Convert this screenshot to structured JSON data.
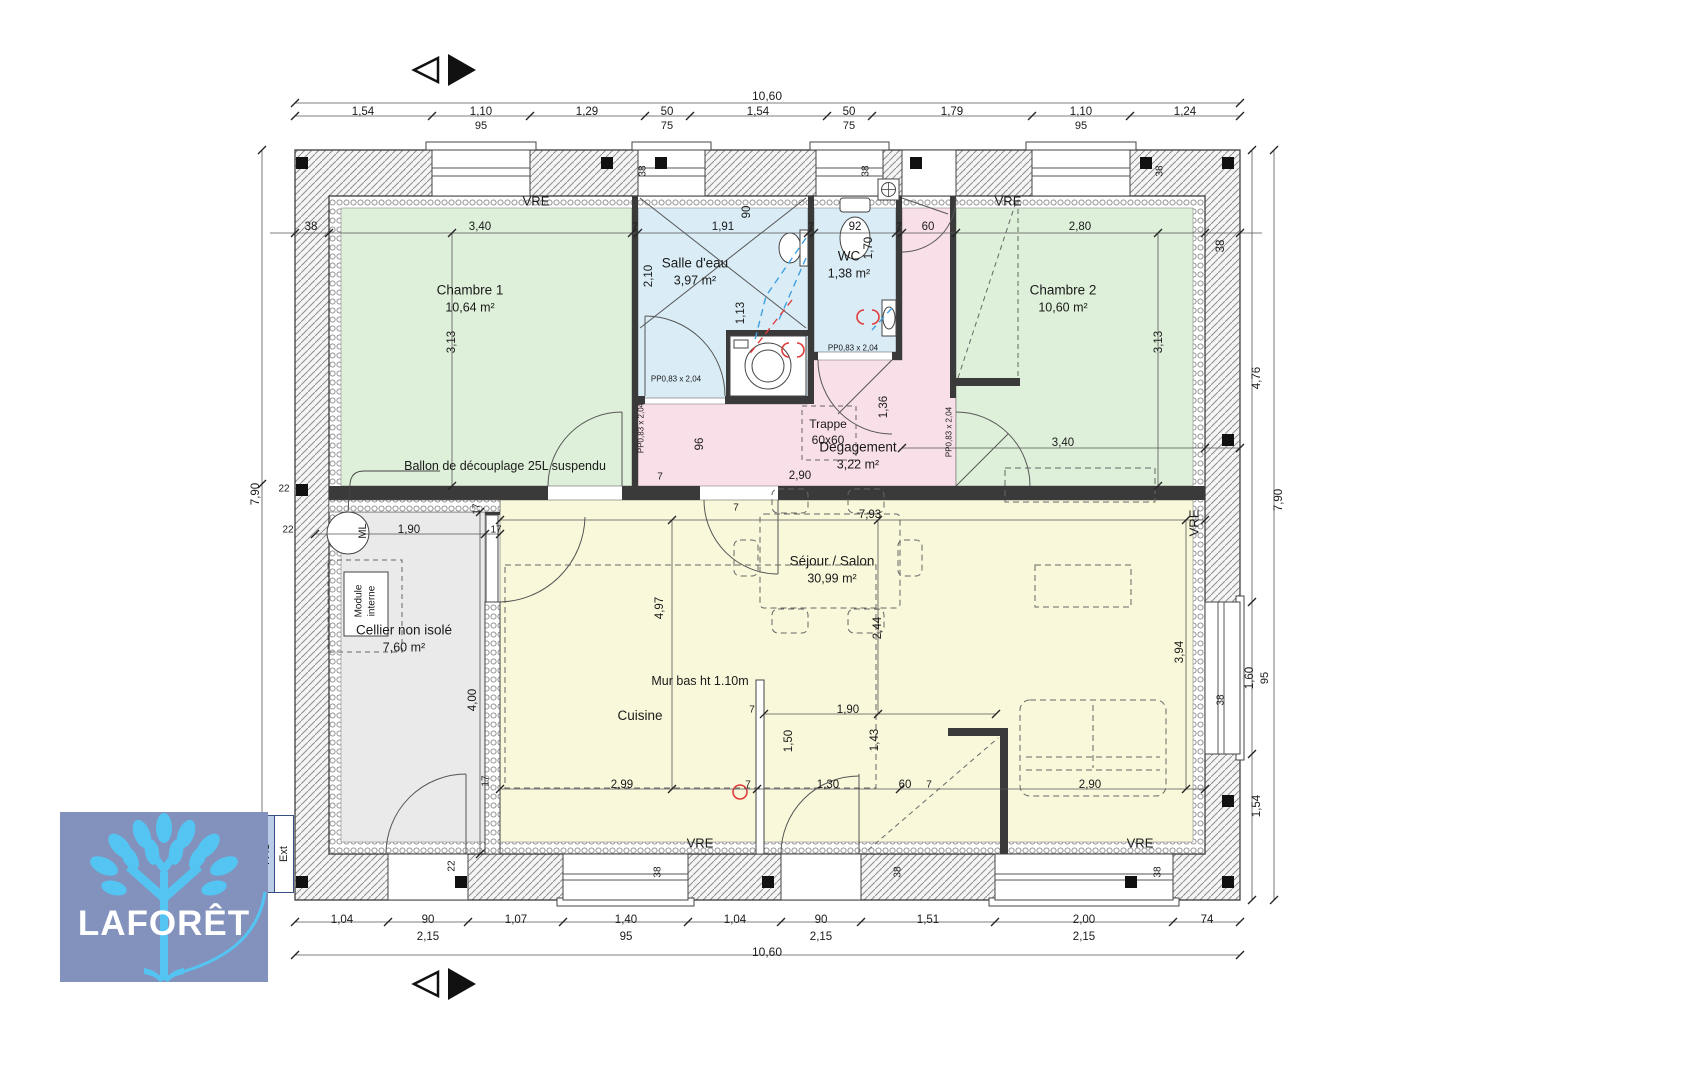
{
  "branding": {
    "logo_text": "LAFORÊT",
    "pac_label": "PAC",
    "ext_label": "Ext"
  },
  "colors": {
    "bedroom": "#dff0da",
    "water": "#daedf7",
    "hall": "#f9dfe8",
    "living": "#f9f8da",
    "cellar": "#eaeaea",
    "wall": "#3a3a3a",
    "dim": "#1a1a1a",
    "logo_bg": "#8292bd",
    "logo_tree": "#54c5f2",
    "logo_text": "#ffffff",
    "pipe_cold": "#3f9fe0",
    "pipe_hot": "#e03b3b",
    "accent_red": "#e03b3b"
  },
  "rooms": [
    {
      "name": "Chambre 1",
      "area": "10,64 m²"
    },
    {
      "name": "Salle d'eau",
      "area": "3,97 m²"
    },
    {
      "name": "WC",
      "area": "1,38 m²"
    },
    {
      "name": "Chambre 2",
      "area": "10,60 m²"
    },
    {
      "name": "Degagement",
      "area": "3,22 m²"
    },
    {
      "name": "Cellier non isolé",
      "area": "7,60 m²"
    },
    {
      "name": "Séjour / Salon",
      "area": "30,99 m²"
    },
    {
      "name": "Cuisine",
      "area": ""
    }
  ],
  "labels": [
    {
      "t": "10,60",
      "x": 767,
      "y": 96,
      "s": 12,
      "n": "dim-total-top"
    },
    {
      "t": "1,54",
      "x": 363,
      "y": 112
    },
    {
      "t": "1,10",
      "x": 481,
      "y": 112
    },
    {
      "t": "95",
      "x": 481,
      "y": 126,
      "s": 11
    },
    {
      "t": "1,29",
      "x": 587,
      "y": 112
    },
    {
      "t": "50",
      "x": 667,
      "y": 112
    },
    {
      "t": "75",
      "x": 667,
      "y": 126,
      "s": 11
    },
    {
      "t": "1,54",
      "x": 758,
      "y": 112
    },
    {
      "t": "50",
      "x": 849,
      "y": 112
    },
    {
      "t": "75",
      "x": 849,
      "y": 126,
      "s": 11
    },
    {
      "t": "1,79",
      "x": 952,
      "y": 112
    },
    {
      "t": "1,10",
      "x": 1081,
      "y": 112
    },
    {
      "t": "95",
      "x": 1081,
      "y": 126,
      "s": 11
    },
    {
      "t": "1,24",
      "x": 1185,
      "y": 112
    },
    {
      "t": "38",
      "x": 311,
      "y": 227
    },
    {
      "t": "3,40",
      "x": 480,
      "y": 227
    },
    {
      "t": "7",
      "x": 635,
      "y": 227,
      "s": 10
    },
    {
      "t": "1,91",
      "x": 723,
      "y": 227
    },
    {
      "t": "90",
      "x": 747,
      "y": 212,
      "r": 1
    },
    {
      "t": "7",
      "x": 811,
      "y": 227,
      "s": 10
    },
    {
      "t": "92",
      "x": 855,
      "y": 227
    },
    {
      "t": "7",
      "x": 899,
      "y": 227,
      "s": 10
    },
    {
      "t": "60",
      "x": 928,
      "y": 227
    },
    {
      "t": "2,80",
      "x": 1080,
      "y": 227
    },
    {
      "t": "38",
      "x": 1221,
      "y": 246,
      "r": 1
    },
    {
      "t": "38",
      "x": 643,
      "y": 171,
      "r": 1,
      "s": 10
    },
    {
      "t": "38",
      "x": 866,
      "y": 171,
      "r": 1,
      "s": 10
    },
    {
      "t": "38",
      "x": 1160,
      "y": 171,
      "r": 1,
      "s": 10
    },
    {
      "t": "3,13",
      "x": 452,
      "y": 342,
      "r": 1
    },
    {
      "t": "2,10",
      "x": 649,
      "y": 276,
      "r": 1
    },
    {
      "t": "1,13",
      "x": 741,
      "y": 313,
      "r": 1
    },
    {
      "t": "1,70",
      "x": 869,
      "y": 248,
      "r": 1
    },
    {
      "t": "3,13",
      "x": 1159,
      "y": 342,
      "r": 1
    },
    {
      "t": "96",
      "x": 700,
      "y": 444,
      "r": 1
    },
    {
      "t": "1,36",
      "x": 884,
      "y": 407,
      "r": 1
    },
    {
      "t": "2,90",
      "x": 800,
      "y": 476
    },
    {
      "t": "Trappe",
      "x": 828,
      "y": 424,
      "s": 12,
      "n": "trappe-label"
    },
    {
      "t": "60x60",
      "x": 828,
      "y": 440,
      "s": 12,
      "n": "trappe-size-label"
    },
    {
      "t": "PP0,83 x 2,04",
      "x": 676,
      "y": 379,
      "s": 8,
      "n": "door-size-label"
    },
    {
      "t": "PP0,83 x 2,04",
      "x": 641,
      "y": 428,
      "r": 1,
      "s": 8,
      "n": "door-size-label"
    },
    {
      "t": "PP0,83 x 2,04",
      "x": 853,
      "y": 348,
      "s": 8,
      "n": "door-size-label"
    },
    {
      "t": "PP0,83 x 2,04",
      "x": 949,
      "y": 432,
      "r": 1,
      "s": 8,
      "n": "door-size-label"
    },
    {
      "t": "3,40",
      "x": 1063,
      "y": 443
    },
    {
      "t": "VRE",
      "x": 536,
      "y": 201,
      "s": 13,
      "n": "vre-label"
    },
    {
      "t": "VRE",
      "x": 1008,
      "y": 201,
      "s": 13,
      "n": "vre-label"
    },
    {
      "t": "VRE",
      "x": 700,
      "y": 843,
      "s": 13,
      "n": "vre-label"
    },
    {
      "t": "VRE",
      "x": 1140,
      "y": 843,
      "s": 13,
      "n": "vre-label"
    },
    {
      "t": "VRE",
      "x": 1194,
      "y": 523,
      "r": 1,
      "s": 13,
      "n": "vre-label"
    },
    {
      "t": "Ballon de découplage 25L suspendu",
      "x": 505,
      "y": 466,
      "s": 12.5,
      "n": "ballon-label"
    },
    {
      "t": "ML",
      "x": 363,
      "y": 531,
      "r": 1,
      "s": 11,
      "n": "ml-label"
    },
    {
      "t": "Module",
      "x": 359,
      "y": 601,
      "r": 1,
      "s": 10,
      "n": "module-label"
    },
    {
      "t": "interne",
      "x": 372,
      "y": 601,
      "r": 1,
      "s": 10,
      "n": "module-label"
    },
    {
      "t": "22",
      "x": 288,
      "y": 530,
      "s": 10
    },
    {
      "t": "1,90",
      "x": 409,
      "y": 530
    },
    {
      "t": "17",
      "x": 477,
      "y": 509,
      "r": 1,
      "s": 10
    },
    {
      "t": "17",
      "x": 496,
      "y": 530,
      "s": 10
    },
    {
      "t": "4,00",
      "x": 473,
      "y": 700,
      "r": 1
    },
    {
      "t": "22",
      "x": 452,
      "y": 866,
      "r": 1,
      "s": 10
    },
    {
      "t": "7",
      "x": 660,
      "y": 477,
      "s": 10
    },
    {
      "t": "7,93",
      "x": 870,
      "y": 515
    },
    {
      "t": "7",
      "x": 736,
      "y": 508,
      "s": 10
    },
    {
      "t": "4,97",
      "x": 660,
      "y": 608,
      "r": 1
    },
    {
      "t": "2,44",
      "x": 878,
      "y": 628,
      "r": 1
    },
    {
      "t": "3,94",
      "x": 1180,
      "y": 652,
      "r": 1
    },
    {
      "t": "Mur bas ht 1.10m",
      "x": 700,
      "y": 681,
      "s": 12.5,
      "n": "low-wall-label"
    },
    {
      "t": "7",
      "x": 752,
      "y": 710,
      "s": 10
    },
    {
      "t": "1,90",
      "x": 848,
      "y": 710
    },
    {
      "t": "1,50",
      "x": 789,
      "y": 741,
      "r": 1
    },
    {
      "t": "1,43",
      "x": 875,
      "y": 740,
      "r": 1
    },
    {
      "t": "2,99",
      "x": 622,
      "y": 785
    },
    {
      "t": "7",
      "x": 748,
      "y": 785,
      "s": 10
    },
    {
      "t": "1,30",
      "x": 828,
      "y": 785
    },
    {
      "t": "60",
      "x": 905,
      "y": 785
    },
    {
      "t": "7",
      "x": 929,
      "y": 785,
      "s": 10
    },
    {
      "t": "2,90",
      "x": 1090,
      "y": 785
    },
    {
      "t": "17",
      "x": 486,
      "y": 781,
      "r": 1,
      "s": 10
    },
    {
      "t": "38",
      "x": 658,
      "y": 872,
      "r": 1,
      "s": 10
    },
    {
      "t": "38",
      "x": 898,
      "y": 872,
      "r": 1,
      "s": 10
    },
    {
      "t": "38",
      "x": 1158,
      "y": 872,
      "r": 1,
      "s": 10
    },
    {
      "t": "1,04",
      "x": 342,
      "y": 920
    },
    {
      "t": "90",
      "x": 428,
      "y": 920
    },
    {
      "t": "1,07",
      "x": 516,
      "y": 920
    },
    {
      "t": "1,40",
      "x": 626,
      "y": 920
    },
    {
      "t": "1,04",
      "x": 735,
      "y": 920
    },
    {
      "t": "90",
      "x": 821,
      "y": 920
    },
    {
      "t": "1,51",
      "x": 928,
      "y": 920
    },
    {
      "t": "2,00",
      "x": 1084,
      "y": 920
    },
    {
      "t": "74",
      "x": 1207,
      "y": 920
    },
    {
      "t": "2,15",
      "x": 428,
      "y": 937
    },
    {
      "t": "95",
      "x": 626,
      "y": 937
    },
    {
      "t": "2,15",
      "x": 821,
      "y": 937
    },
    {
      "t": "2,15",
      "x": 1084,
      "y": 937
    },
    {
      "t": "10,60",
      "x": 767,
      "y": 952,
      "s": 12,
      "n": "dim-total-bottom"
    },
    {
      "t": "7,90",
      "x": 256,
      "y": 494,
      "r": 1,
      "n": "dim-total-left"
    },
    {
      "t": "22",
      "x": 284,
      "y": 489,
      "s": 10
    },
    {
      "t": "4,76",
      "x": 1257,
      "y": 378,
      "r": 1
    },
    {
      "t": "1,60",
      "x": 1250,
      "y": 678,
      "r": 1
    },
    {
      "t": "95",
      "x": 1265,
      "y": 678,
      "r": 1,
      "s": 11
    },
    {
      "t": "1,54",
      "x": 1257,
      "y": 806,
      "r": 1
    },
    {
      "t": "7,90",
      "x": 1279,
      "y": 500,
      "r": 1,
      "n": "dim-total-right"
    },
    {
      "t": "38",
      "x": 1221,
      "y": 700,
      "r": 1,
      "s": 10
    }
  ]
}
